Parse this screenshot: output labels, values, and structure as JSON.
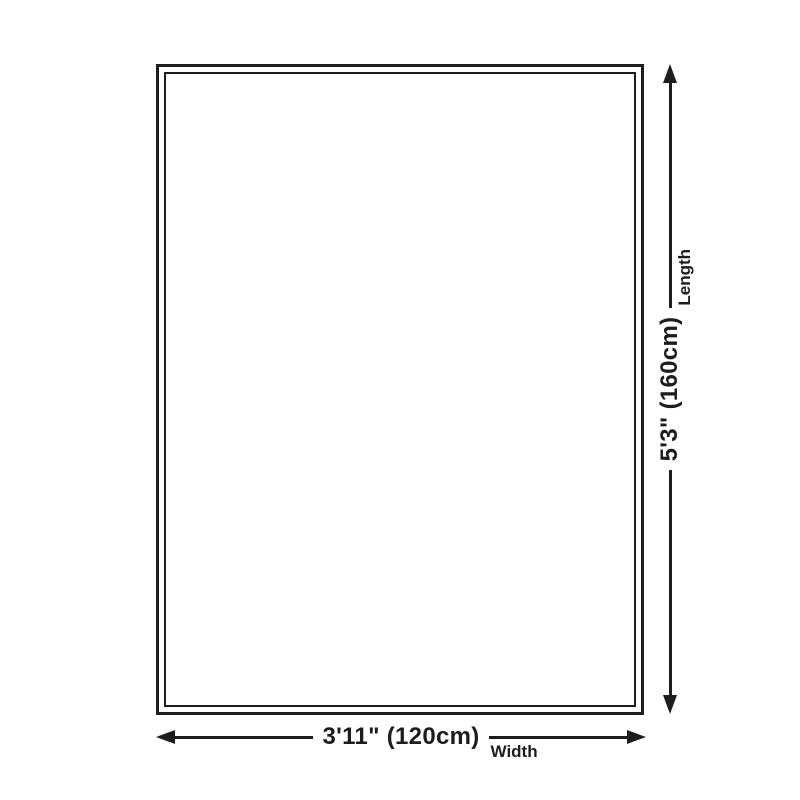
{
  "colors": {
    "ink": "#1d1d1d",
    "bg": "#ffffff"
  },
  "dimensions": {
    "width": {
      "value": "3'11\" (120cm)",
      "label": "Width"
    },
    "length": {
      "value": "5'3\" (160cm)",
      "label": "Length"
    }
  }
}
